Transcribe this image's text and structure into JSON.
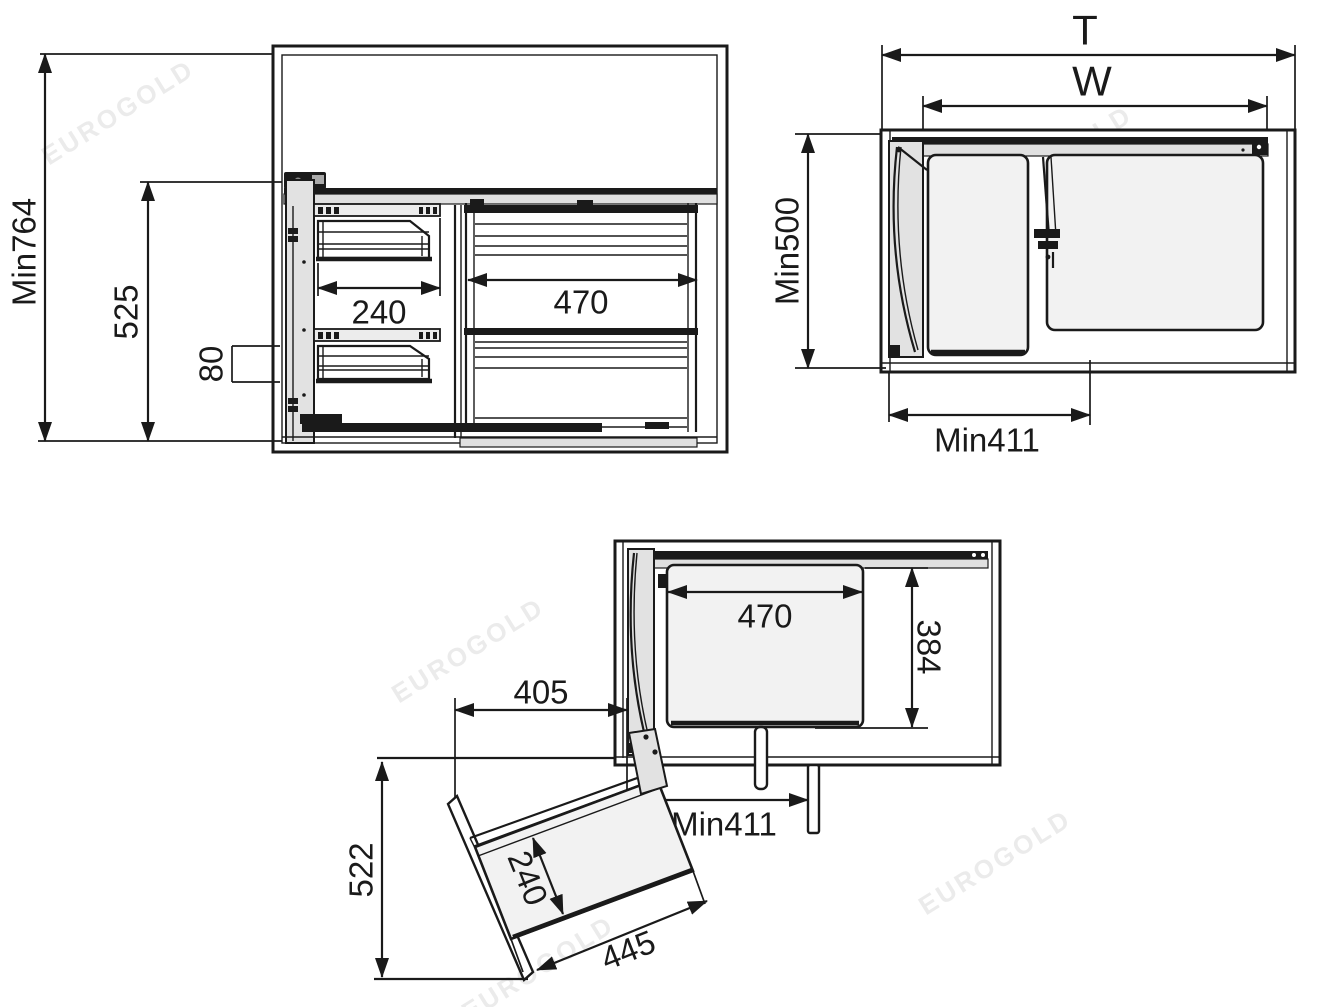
{
  "figure": {
    "type": "technical-dimension-drawing",
    "subject": "corner cabinet pull-out basket mechanism",
    "background_color": "#ffffff",
    "line_color": "#1a1a1a",
    "panel_fill_color": "#f2f2f2",
    "door_fill_color": "#e2e2e2",
    "watermark_text": "EUROGOLD",
    "watermark_color": "#ebebeb"
  },
  "views": {
    "front": {
      "name": "front-view-closed",
      "labels": {
        "overall_height": "Min764",
        "carriage_height": "525",
        "bracket_gap": "80",
        "door_basket_width": "240",
        "main_basket_width": "470"
      }
    },
    "top_closed": {
      "name": "top-view-closed",
      "labels": {
        "total_depth": "T",
        "internal_width": "W",
        "min_depth": "Min500",
        "min_door_width": "Min411"
      }
    },
    "top_open": {
      "name": "top-view-door-open",
      "labels": {
        "basket_width": "470",
        "basket_depth": "384",
        "door_offset": "405",
        "min_door_width": "Min411",
        "swing_depth": "522",
        "door_basket_depth": "240",
        "door_basket_length": "445"
      }
    }
  }
}
